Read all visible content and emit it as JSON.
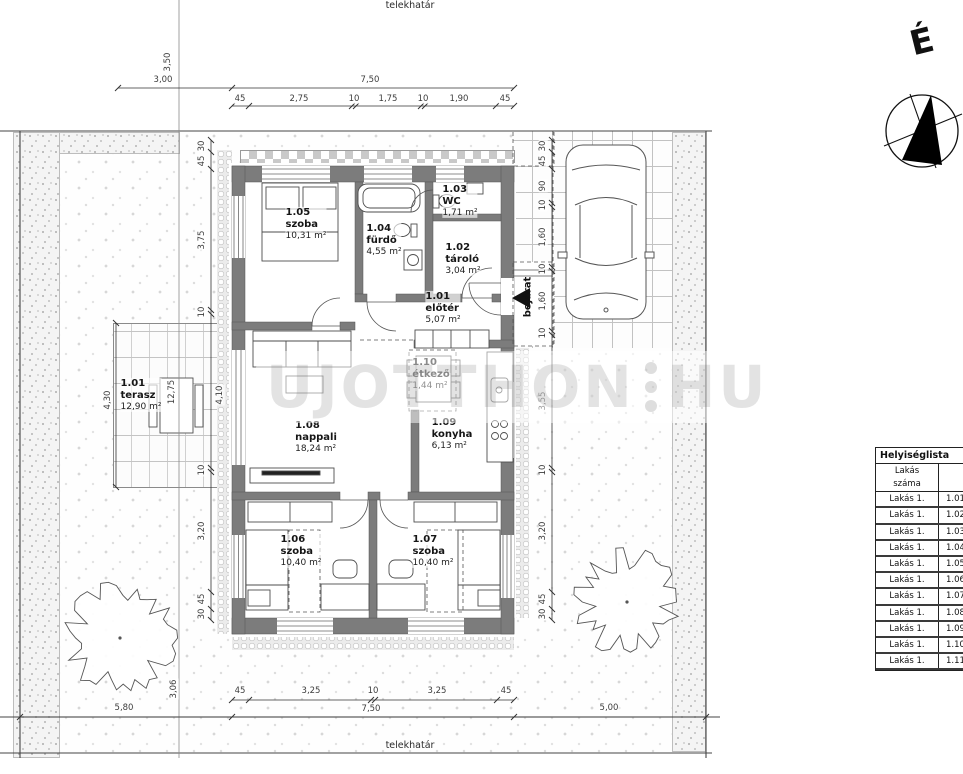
{
  "boundary": {
    "top": "telekhatár",
    "bottom": "telekhatár"
  },
  "compass": {
    "north": "É"
  },
  "watermark": {
    "text_left": "UJOTTHON",
    "text_right": "HU"
  },
  "entrance": {
    "label": "bejárat"
  },
  "colors": {
    "wall": "#7c7c7c",
    "line": "#4e4e4e",
    "dim_text": "#3d3d3d"
  },
  "rooms": [
    {
      "id": "1.05",
      "name": "szoba",
      "area": "10,31 m²",
      "x": 306,
      "y": 224
    },
    {
      "id": "1.04",
      "name": "fürdő",
      "area": "4,55 m²",
      "x": 384,
      "y": 240
    },
    {
      "id": "1.03",
      "name": "WC",
      "area": "1,71 m²",
      "x": 460,
      "y": 201
    },
    {
      "id": "1.02",
      "name": "tároló",
      "area": "3,04 m²",
      "x": 463,
      "y": 259
    },
    {
      "id": "1.01",
      "name": "előtér",
      "area": "5,07 m²",
      "x": 443,
      "y": 308
    },
    {
      "id": "1.10",
      "name": "étkező",
      "area": "1,44 m²",
      "x": 431,
      "y": 374
    },
    {
      "id": "1.08",
      "name": "nappali",
      "area": "18,24 m²",
      "x": 316,
      "y": 437
    },
    {
      "id": "1.09",
      "name": "konyha",
      "area": "6,13 m²",
      "x": 452,
      "y": 434
    },
    {
      "id": "1.06",
      "name": "szoba",
      "area": "10,40 m²",
      "x": 301,
      "y": 551
    },
    {
      "id": "1.07",
      "name": "szoba",
      "area": "10,40 m²",
      "x": 433,
      "y": 551
    },
    {
      "id": "1.01",
      "name": "terasz",
      "area": "12,90 m²",
      "x": 141,
      "y": 395
    }
  ],
  "dimensions": [
    {
      "t": "3,50",
      "x": 168,
      "y": 62,
      "r": -90
    },
    {
      "t": "3,00",
      "x": 163,
      "y": 80,
      "r": 0
    },
    {
      "t": "7,50",
      "x": 370,
      "y": 80,
      "r": 0
    },
    {
      "t": "45",
      "x": 240,
      "y": 99,
      "r": 0
    },
    {
      "t": "2,75",
      "x": 299,
      "y": 99,
      "r": 0
    },
    {
      "t": "10",
      "x": 354,
      "y": 99,
      "r": 0
    },
    {
      "t": "1,75",
      "x": 388,
      "y": 99,
      "r": 0
    },
    {
      "t": "10",
      "x": 423,
      "y": 99,
      "r": 0
    },
    {
      "t": "1,90",
      "x": 459,
      "y": 99,
      "r": 0
    },
    {
      "t": "45",
      "x": 505,
      "y": 99,
      "r": 0
    },
    {
      "t": "30",
      "x": 202,
      "y": 146,
      "r": -90
    },
    {
      "t": "45",
      "x": 202,
      "y": 161,
      "r": -90
    },
    {
      "t": "3,75",
      "x": 202,
      "y": 240,
      "r": -90
    },
    {
      "t": "10",
      "x": 202,
      "y": 312,
      "r": -90
    },
    {
      "t": "4,10",
      "x": 220,
      "y": 395,
      "r": -90
    },
    {
      "t": "10",
      "x": 202,
      "y": 470,
      "r": -90
    },
    {
      "t": "3,20",
      "x": 202,
      "y": 531,
      "r": -90
    },
    {
      "t": "45",
      "x": 202,
      "y": 599,
      "r": -90
    },
    {
      "t": "30",
      "x": 202,
      "y": 614,
      "r": -90
    },
    {
      "t": "4,30",
      "x": 108,
      "y": 400,
      "r": -90
    },
    {
      "t": "12,75",
      "x": 172,
      "y": 392,
      "r": -90
    },
    {
      "t": "30",
      "x": 543,
      "y": 146,
      "r": -90
    },
    {
      "t": "45",
      "x": 543,
      "y": 161,
      "r": -90
    },
    {
      "t": "90",
      "x": 543,
      "y": 186,
      "r": -90
    },
    {
      "t": "10",
      "x": 543,
      "y": 205,
      "r": -90
    },
    {
      "t": "1,60",
      "x": 543,
      "y": 237,
      "r": -90
    },
    {
      "t": "10",
      "x": 543,
      "y": 269,
      "r": -90
    },
    {
      "t": "1,60",
      "x": 543,
      "y": 301,
      "r": -90
    },
    {
      "t": "10",
      "x": 543,
      "y": 333,
      "r": -90
    },
    {
      "t": "3,55",
      "x": 543,
      "y": 401,
      "r": -90
    },
    {
      "t": "10",
      "x": 543,
      "y": 470,
      "r": -90
    },
    {
      "t": "3,20",
      "x": 543,
      "y": 531,
      "r": -90
    },
    {
      "t": "45",
      "x": 543,
      "y": 599,
      "r": -90
    },
    {
      "t": "30",
      "x": 543,
      "y": 614,
      "r": -90
    },
    {
      "t": "45",
      "x": 240,
      "y": 691,
      "r": 0
    },
    {
      "t": "3,25",
      "x": 311,
      "y": 691,
      "r": 0
    },
    {
      "t": "10",
      "x": 373,
      "y": 691,
      "r": 0
    },
    {
      "t": "3,25",
      "x": 437,
      "y": 691,
      "r": 0
    },
    {
      "t": "45",
      "x": 506,
      "y": 691,
      "r": 0
    },
    {
      "t": "7,50",
      "x": 371,
      "y": 709,
      "r": 0
    },
    {
      "t": "5,80",
      "x": 124,
      "y": 708,
      "r": 0
    },
    {
      "t": "5,00",
      "x": 609,
      "y": 708,
      "r": 0
    },
    {
      "t": "3,06",
      "x": 174,
      "y": 689,
      "r": -90
    }
  ],
  "room_list": {
    "title": "Helyiséglista",
    "columns": [
      [
        "Lakás",
        "száma"
      ],
      [
        "Helyiség",
        "száma"
      ]
    ],
    "rows": [
      [
        "Lakás 1.",
        "1.01"
      ],
      [
        "Lakás 1.",
        "1.02"
      ],
      [
        "Lakás 1.",
        "1.03"
      ],
      [
        "Lakás 1.",
        "1.04"
      ],
      [
        "Lakás 1.",
        "1.05"
      ],
      [
        "Lakás 1.",
        "1.06"
      ],
      [
        "Lakás 1.",
        "1.07"
      ],
      [
        "Lakás 1.",
        "1.08"
      ],
      [
        "Lakás 1.",
        "1.09"
      ],
      [
        "Lakás 1.",
        "1.10"
      ],
      [
        "Lakás 1.",
        "1.11"
      ]
    ]
  }
}
